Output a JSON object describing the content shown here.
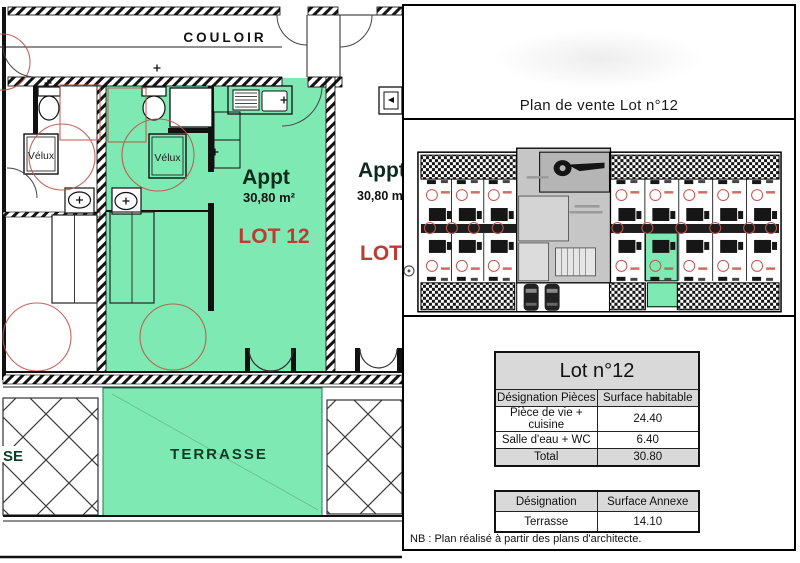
{
  "document": {
    "title": "Plan de vente Lot n°12",
    "note": "NB : Plan réalisé à partir des plans d'architecte."
  },
  "floor_plan": {
    "corridor": "COULOIR",
    "velux": "Vélux",
    "apartment": {
      "label": "Appt",
      "area": "30,80 m²",
      "lot": "LOT 12"
    },
    "neighbor_apartment": {
      "label": "Appt",
      "area": "30,80 m",
      "lot": "LOT"
    },
    "terrace": "TERRASSE",
    "neighbor_terrace_fragment": "SE"
  },
  "tables": {
    "lot": {
      "title": "Lot n°12",
      "col1": "Désignation Pièces",
      "col2": "Surface habitable",
      "rows": [
        {
          "label": "Pièce de vie + cuisine",
          "value": "24.40"
        },
        {
          "label": "Salle d'eau + WC",
          "value": "6.40"
        },
        {
          "label": "Total",
          "value": "30.80"
        }
      ]
    },
    "annex": {
      "col1": "Désignation",
      "col2": "Surface Annexe",
      "rows": [
        {
          "label": "Terrasse",
          "value": "14.10"
        }
      ]
    }
  },
  "colors": {
    "highlight_green": "#7fe9b3",
    "annotation_red": "#c0544a",
    "table_header_gray": "#d9d9d9",
    "wall_black": "#111111"
  }
}
